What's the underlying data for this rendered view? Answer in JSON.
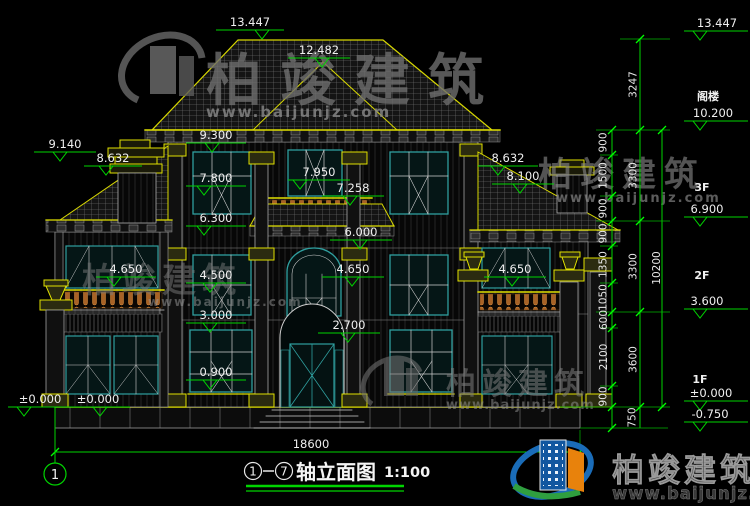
{
  "drawing": {
    "title": {
      "axis_from": "1",
      "axis_to": "7",
      "name": "轴立面图",
      "scale": "1:100"
    },
    "sheet_axis_bubble": "1",
    "total_width_dim": "18600",
    "markers": {
      "m13447": "13.447",
      "m12482": "12.482",
      "m9300": "9.300",
      "m9140": "9.140",
      "m8632L": "8.632",
      "m7800": "7.800",
      "m7950": "7.950",
      "m7258": "7.258",
      "m8632R": "8.632",
      "m8100": "8.100",
      "m6300": "6.300",
      "m6000": "6.000",
      "m4650L": "4.650",
      "m4500": "4.500",
      "m4650C": "4.650",
      "m4650R": "4.650",
      "m3000": "3.000",
      "m2700": "2.700",
      "m0900": "0.900",
      "m0000a": "±0.000",
      "m0000b": "±0.000"
    },
    "right_panel": {
      "top": "13.447",
      "floors": [
        {
          "label": "阁楼",
          "elev": "10.200"
        },
        {
          "label": "3F",
          "elev": "6.900"
        },
        {
          "label": "2F",
          "elev": "3.600"
        },
        {
          "label": "1F",
          "elev": "±0.000"
        },
        {
          "label": "",
          "elev": "-0.750"
        }
      ],
      "segments": [
        "900",
        "1500",
        "900",
        "900",
        "1350",
        "1050",
        "600",
        "2100",
        "900",
        "750"
      ],
      "spans": [
        "3247",
        "3300",
        "3300",
        "3600"
      ],
      "total": "10200"
    }
  },
  "branding": {
    "name": "柏竣建筑",
    "url": "www.baijunjz.com"
  },
  "colors": {
    "background": "#000000",
    "dim_green": "#00d400",
    "cad_yellow": "#e0e000",
    "window_teal": "#2f9f9f",
    "baluster_orange": "#a86226",
    "watermark_gray": "#7a7a7a",
    "logo_blue": "#1a6cb8",
    "logo_orange": "#e8820c",
    "logo_green": "#2f9f3f"
  }
}
